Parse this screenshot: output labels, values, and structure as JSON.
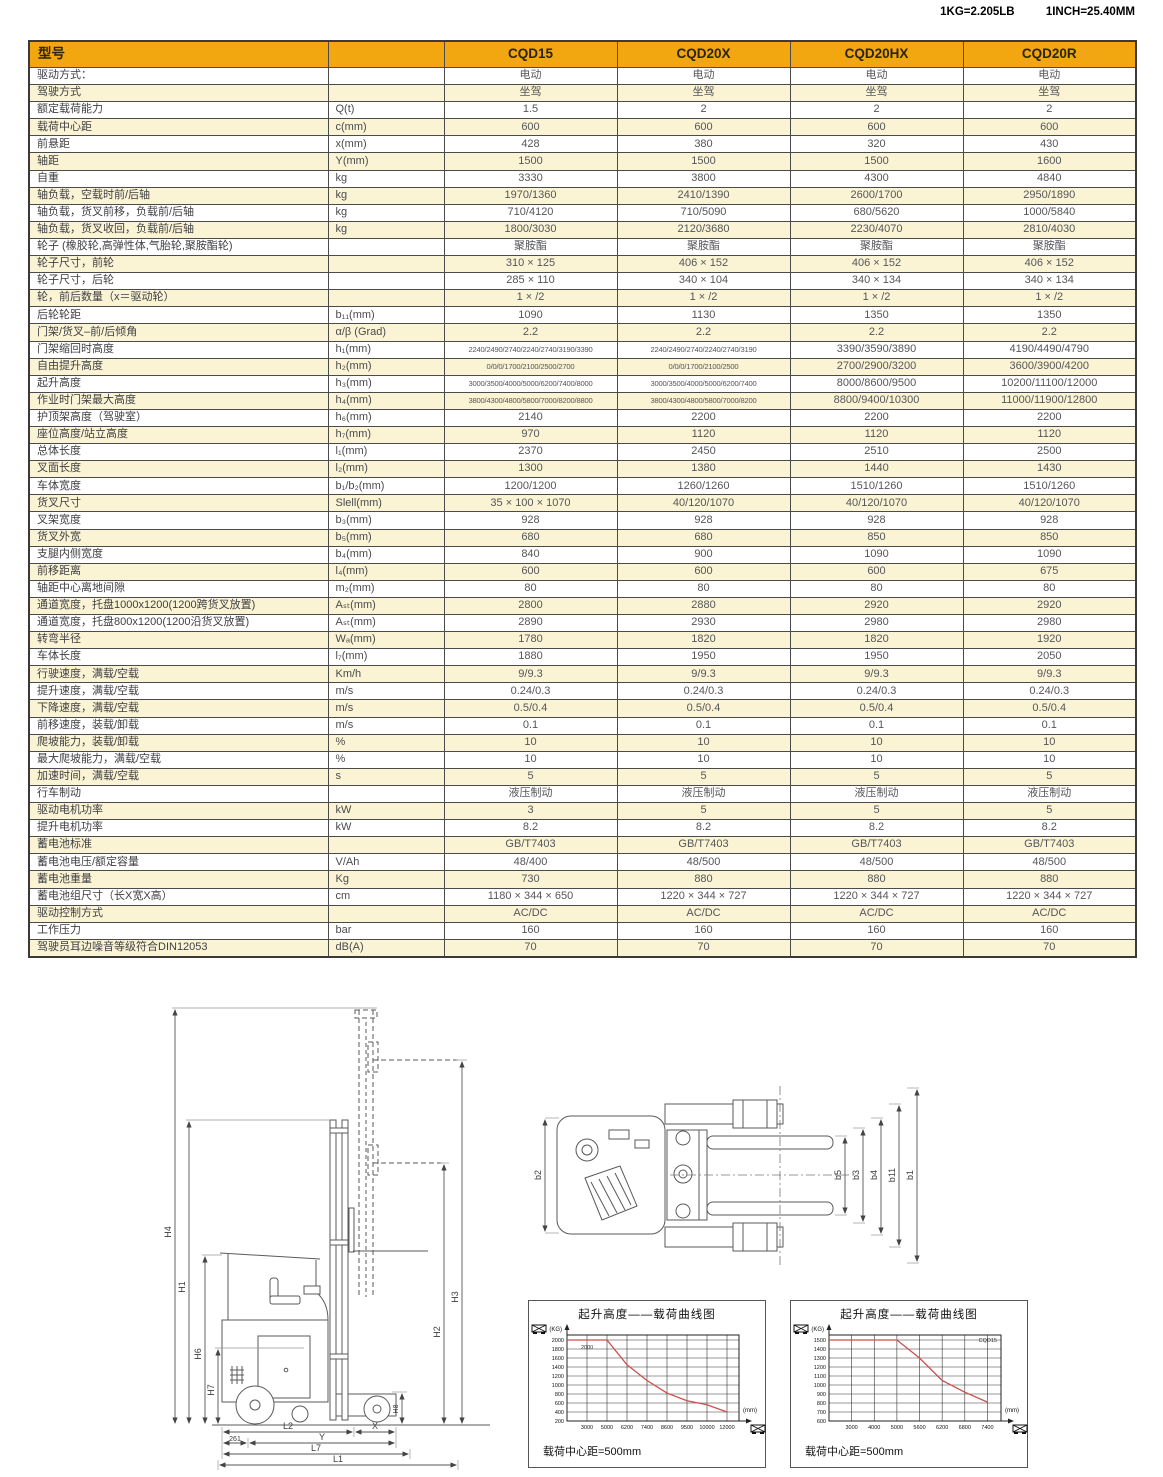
{
  "page": {
    "conversion_note_kg": "1KG=2.205LB",
    "conversion_note_inch": "1INCH=25.40MM"
  },
  "table": {
    "header": {
      "model_col": "型号",
      "models": [
        "CQD15",
        "CQD20X",
        "CQD20HX",
        "CQD20R"
      ]
    },
    "rows": [
      {
        "label": "驱动方式：",
        "unit": "",
        "values": [
          "电动",
          "电动",
          "电动",
          "电动"
        ]
      },
      {
        "label": "驾驶方式",
        "unit": "",
        "values": [
          "坐驾",
          "坐驾",
          "坐驾",
          "坐驾"
        ]
      },
      {
        "label": "额定载荷能力",
        "unit": "Q(t)",
        "values": [
          "1.5",
          "2",
          "2",
          "2"
        ]
      },
      {
        "label": "载荷中心距",
        "unit": "c(mm)",
        "values": [
          "600",
          "600",
          "600",
          "600"
        ]
      },
      {
        "label": "前悬距",
        "unit": "x(mm)",
        "values": [
          "428",
          "380",
          "320",
          "430"
        ]
      },
      {
        "label": "轴距",
        "unit": "Y(mm)",
        "values": [
          "1500",
          "1500",
          "1500",
          "1600"
        ]
      },
      {
        "label": "自重",
        "unit": "kg",
        "values": [
          "3330",
          "3800",
          "4300",
          "4840"
        ]
      },
      {
        "label": "轴负载，空载时前/后轴",
        "unit": "kg",
        "values": [
          "1970/1360",
          "2410/1390",
          "2600/1700",
          "2950/1890"
        ]
      },
      {
        "label": "轴负载，货叉前移，负载前/后轴",
        "unit": "kg",
        "values": [
          "710/4120",
          "710/5090",
          "680/5620",
          "1000/5840"
        ]
      },
      {
        "label": "轴负载，货叉收回，负载前/后轴",
        "unit": "kg",
        "values": [
          "1800/3030",
          "2120/3680",
          "2230/4070",
          "2810/4030"
        ]
      },
      {
        "label": "轮子 (橡胶轮,高弹性体,气胎轮,聚胺酯轮)",
        "unit": "",
        "values": [
          "聚胺酯",
          "聚胺酯",
          "聚胺酯",
          "聚胺酯"
        ]
      },
      {
        "label": "轮子尺寸，前轮",
        "unit": "",
        "values": [
          "310 × 125",
          "406 × 152",
          "406 × 152",
          "406 × 152"
        ]
      },
      {
        "label": "轮子尺寸，后轮",
        "unit": "",
        "values": [
          "285 × 110",
          "340 × 104",
          "340 × 134",
          "340 × 134"
        ]
      },
      {
        "label": "轮，前后数量（x＝驱动轮）",
        "unit": "",
        "values": [
          "1 × /2",
          "1 × /2",
          "1 × /2",
          "1 × /2"
        ]
      },
      {
        "label": "后轮轮距",
        "unit": "b₁₁(mm)",
        "values": [
          "1090",
          "1130",
          "1350",
          "1350"
        ]
      },
      {
        "label": "门架/货叉–前/后倾角",
        "unit": "α/β (Grad)",
        "values": [
          "2.2",
          "2.2",
          "2.2",
          "2.2"
        ]
      },
      {
        "label": "门架缩回时高度",
        "unit": "h₁(mm)",
        "values": [
          "2240/2490/2740/2240/2740/3190/3390",
          "2240/2490/2740/2240/2740/3190",
          "3390/3590/3890",
          "4190/4490/4790"
        ]
      },
      {
        "label": "自由提升高度",
        "unit": "h₂(mm)",
        "values": [
          "0/0/0/1700/2100/2500/2700",
          "0/0/0/1700/2100/2500",
          "2700/2900/3200",
          "3600/3900/4200"
        ]
      },
      {
        "label": "起升高度",
        "unit": "h₃(mm)",
        "values": [
          "3000/3500/4000/5000/6200/7400/8000",
          "3000/3500/4000/5000/6200/7400",
          "8000/8600/9500",
          "10200/11100/12000"
        ]
      },
      {
        "label": "作业时门架最大高度",
        "unit": "h₄(mm)",
        "values": [
          "3800/4300/4800/5800/7000/8200/8800",
          "3800/4300/4800/5800/7000/8200",
          "8800/9400/10300",
          "11000/11900/12800"
        ]
      },
      {
        "label": "护顶架高度（驾驶室）",
        "unit": "h₆(mm)",
        "values": [
          "2140",
          "2200",
          "2200",
          "2200"
        ]
      },
      {
        "label": "座位高度/站立高度",
        "unit": "h₇(mm)",
        "values": [
          "970",
          "1120",
          "1120",
          "1120"
        ]
      },
      {
        "label": "总体长度",
        "unit": "l₁(mm)",
        "values": [
          "2370",
          "2450",
          "2510",
          "2500"
        ]
      },
      {
        "label": "叉面长度",
        "unit": "l₂(mm)",
        "values": [
          "1300",
          "1380",
          "1440",
          "1430"
        ]
      },
      {
        "label": "车体宽度",
        "unit": "b₁/b₂(mm)",
        "values": [
          "1200/1200",
          "1260/1260",
          "1510/1260",
          "1510/1260"
        ]
      },
      {
        "label": "货叉尺寸",
        "unit": "Slell(mm)",
        "values": [
          "35 × 100 × 1070",
          "40/120/1070",
          "40/120/1070",
          "40/120/1070"
        ]
      },
      {
        "label": "叉架宽度",
        "unit": "b₃(mm)",
        "values": [
          "928",
          "928",
          "928",
          "928"
        ]
      },
      {
        "label": "货叉外宽",
        "unit": "b₅(mm)",
        "values": [
          "680",
          "680",
          "850",
          "850"
        ]
      },
      {
        "label": "支腿内侧宽度",
        "unit": "b₄(mm)",
        "values": [
          "840",
          "900",
          "1090",
          "1090"
        ]
      },
      {
        "label": "前移距离",
        "unit": "l₄(mm)",
        "values": [
          "600",
          "600",
          "600",
          "675"
        ]
      },
      {
        "label": "轴距中心离地间隙",
        "unit": "m₂(mm)",
        "values": [
          "80",
          "80",
          "80",
          "80"
        ]
      },
      {
        "label": "通道宽度，托盘1000x1200(1200跨货叉放置)",
        "unit": "Aₛₜ(mm)",
        "values": [
          "2800",
          "2880",
          "2920",
          "2920"
        ]
      },
      {
        "label": "通道宽度，托盘800x1200(1200沿货叉放置)",
        "unit": "Aₛₜ(mm)",
        "values": [
          "2890",
          "2930",
          "2980",
          "2980"
        ]
      },
      {
        "label": "转弯半径",
        "unit": "Wₐ(mm)",
        "values": [
          "1780",
          "1820",
          "1820",
          "1920"
        ]
      },
      {
        "label": "车体长度",
        "unit": "l₇(mm)",
        "values": [
          "1880",
          "1950",
          "1950",
          "2050"
        ]
      },
      {
        "label": "行驶速度，满载/空载",
        "unit": "Km/h",
        "values": [
          "9/9.3",
          "9/9.3",
          "9/9.3",
          "9/9.3"
        ]
      },
      {
        "label": "提升速度，满载/空载",
        "unit": "m/s",
        "values": [
          "0.24/0.3",
          "0.24/0.3",
          "0.24/0.3",
          "0.24/0.3"
        ]
      },
      {
        "label": "下降速度，满载/空载",
        "unit": "m/s",
        "values": [
          "0.5/0.4",
          "0.5/0.4",
          "0.5/0.4",
          "0.5/0.4"
        ]
      },
      {
        "label": "前移速度，装载/卸载",
        "unit": "m/s",
        "values": [
          "0.1",
          "0.1",
          "0.1",
          "0.1"
        ]
      },
      {
        "label": "爬坡能力，装载/卸载",
        "unit": "%",
        "values": [
          "10",
          "10",
          "10",
          "10"
        ]
      },
      {
        "label": "最大爬坡能力，满载/空载",
        "unit": "%",
        "values": [
          "10",
          "10",
          "10",
          "10"
        ]
      },
      {
        "label": "加速时间，满载/空载",
        "unit": "s",
        "values": [
          "5",
          "5",
          "5",
          "5"
        ]
      },
      {
        "label": "行车制动",
        "unit": "",
        "values": [
          "液压制动",
          "液压制动",
          "液压制动",
          "液压制动"
        ]
      },
      {
        "label": "驱动电机功率",
        "unit": "kW",
        "values": [
          "3",
          "5",
          "5",
          "5"
        ]
      },
      {
        "label": "提升电机功率",
        "unit": "kW",
        "values": [
          "8.2",
          "8.2",
          "8.2",
          "8.2"
        ]
      },
      {
        "label": "蓄电池标准",
        "unit": "",
        "values": [
          "GB/T7403",
          "GB/T7403",
          "GB/T7403",
          "GB/T7403"
        ]
      },
      {
        "label": "蓄电池电压/额定容量",
        "unit": "V/Ah",
        "values": [
          "48/400",
          "48/500",
          "48/500",
          "48/500"
        ]
      },
      {
        "label": "蓄电池重量",
        "unit": "Kg",
        "values": [
          "730",
          "880",
          "880",
          "880"
        ]
      },
      {
        "label": "蓄电池组尺寸（长X宽X高）",
        "unit": "cm",
        "values": [
          "1180 × 344 × 650",
          "1220 × 344 × 727",
          "1220 × 344 × 727",
          "1220 × 344 × 727"
        ]
      },
      {
        "label": "驱动控制方式",
        "unit": "",
        "values": [
          "AC/DC",
          "AC/DC",
          "AC/DC",
          "AC/DC"
        ]
      },
      {
        "label": "工作压力",
        "unit": "bar",
        "values": [
          "160",
          "160",
          "160",
          "160"
        ]
      },
      {
        "label": "驾驶员耳边噪音等级符合DIN12053",
        "unit": "dB(A)",
        "values": [
          "70",
          "70",
          "70",
          "70"
        ]
      }
    ]
  },
  "side_view": {
    "labels": {
      "h4": "H4",
      "h1": "H1",
      "h6": "H6",
      "h7": "H7",
      "h3": "H3",
      "h2": "H2",
      "h8": "H8",
      "l2": "L2",
      "x": "X",
      "d261": "261",
      "y": "Y",
      "l7": "L7",
      "l1": "L1"
    }
  },
  "top_view": {
    "labels": {
      "b2": "b2",
      "b5": "b5",
      "b3": "b3",
      "b4": "b4",
      "b11": "b11",
      "b1": "b1"
    }
  },
  "chart_data": [
    {
      "type": "line",
      "title": "起升高度——载荷曲线图",
      "caption": "载荷中心距=500mm",
      "ylabel": "(KG)",
      "xlabel": "(mm)",
      "ylim": [
        200,
        2000
      ],
      "ystep": 200,
      "x": [
        3000,
        5000,
        6200,
        7400,
        8600,
        9500,
        10000,
        12000
      ],
      "series": [
        {
          "name": "载荷曲线",
          "values": [
            2000,
            2000,
            1450,
            1100,
            820,
            650,
            560,
            400
          ]
        }
      ],
      "inline_label": "2000",
      "inline_pos": "curve",
      "grid": true,
      "legend": "none"
    },
    {
      "type": "line",
      "title": "起升高度——载荷曲线图",
      "caption": "载荷中心距=500mm",
      "ylabel": "(KG)",
      "xlabel": "(mm)",
      "ylim": [
        600,
        1500
      ],
      "ystep": 100,
      "x": [
        3000,
        4000,
        5000,
        5600,
        6200,
        6800,
        7400
      ],
      "series": [
        {
          "name": "载荷曲线",
          "values": [
            1500,
            1500,
            1500,
            1300,
            1050,
            920,
            810
          ]
        }
      ],
      "inline_label": "CQD15",
      "inline_pos": "topright",
      "grid": true,
      "legend": "none"
    }
  ],
  "colors": {
    "header_bg": "#F2A60F",
    "row_alt": "#FAF3D4",
    "curve": "#C9504B",
    "border": "#4B4B4B"
  }
}
